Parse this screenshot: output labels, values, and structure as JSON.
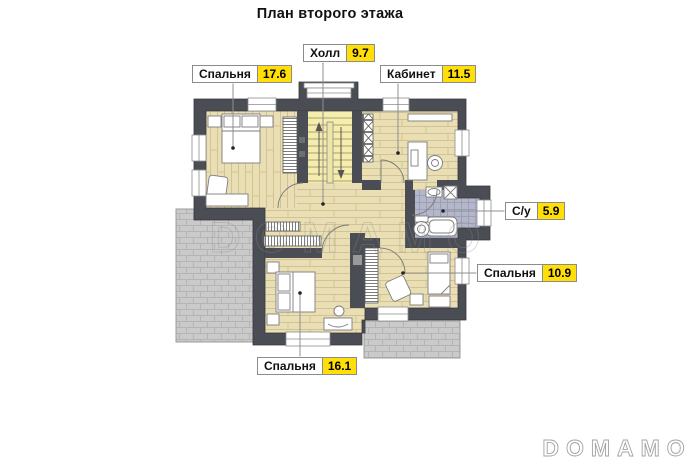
{
  "title": "План второго этажа",
  "watermark": "DOMAMO",
  "brand_logo": "DOMAMO",
  "rooms": [
    {
      "key": "hall",
      "name": "Холл",
      "area": "9.7"
    },
    {
      "key": "bedroom-1",
      "name": "Спальня",
      "area": "17.6"
    },
    {
      "key": "office",
      "name": "Кабинет",
      "area": "11.5"
    },
    {
      "key": "bathroom",
      "name": "С/у",
      "area": "5.9"
    },
    {
      "key": "bedroom-2",
      "name": "Спальня",
      "area": "10.9"
    },
    {
      "key": "bedroom-3",
      "name": "Спальня",
      "area": "16.1"
    }
  ],
  "colors": {
    "wall": "#4a4d53",
    "wood_floor": "#eadfb4",
    "stair_floor": "#f5edad",
    "bathroom_tile": "#b4b7c9",
    "terrace": "#cacaca",
    "label_highlight": "#ffdf07",
    "leader_line": "#8f8f8f"
  }
}
